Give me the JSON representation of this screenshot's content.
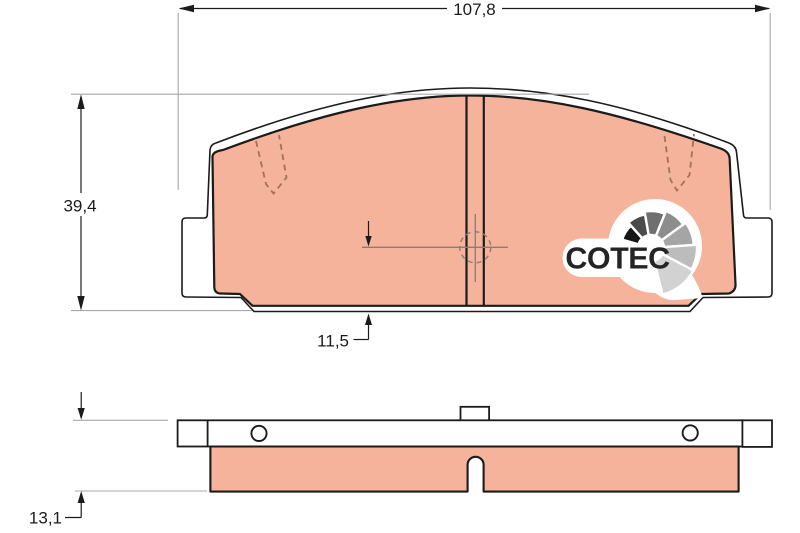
{
  "drawing": {
    "type": "brake-pad-technical-drawing",
    "brand": {
      "logo_text": "COTEC"
    },
    "dimensions": {
      "total_width": {
        "label": "107,8"
      },
      "total_height": {
        "label": "39,4"
      },
      "bottom_offset": {
        "label": "11,5"
      },
      "thickness": {
        "label": "13,1"
      }
    },
    "colors": {
      "friction_fill": "#F6B39B",
      "outline": "#1B1B1B",
      "extension_line": "#A8A8A8",
      "reference_line": "#8C7C72",
      "wear_indicator_line": "#A3705C",
      "logo_text_color": "#242424",
      "logo_fan_segments": [
        "#161616",
        "#4B4B4B",
        "#6F6F6F",
        "#8D8D8D",
        "#A5A5A5",
        "#BCBCBC",
        "#D2D2D2"
      ]
    }
  }
}
